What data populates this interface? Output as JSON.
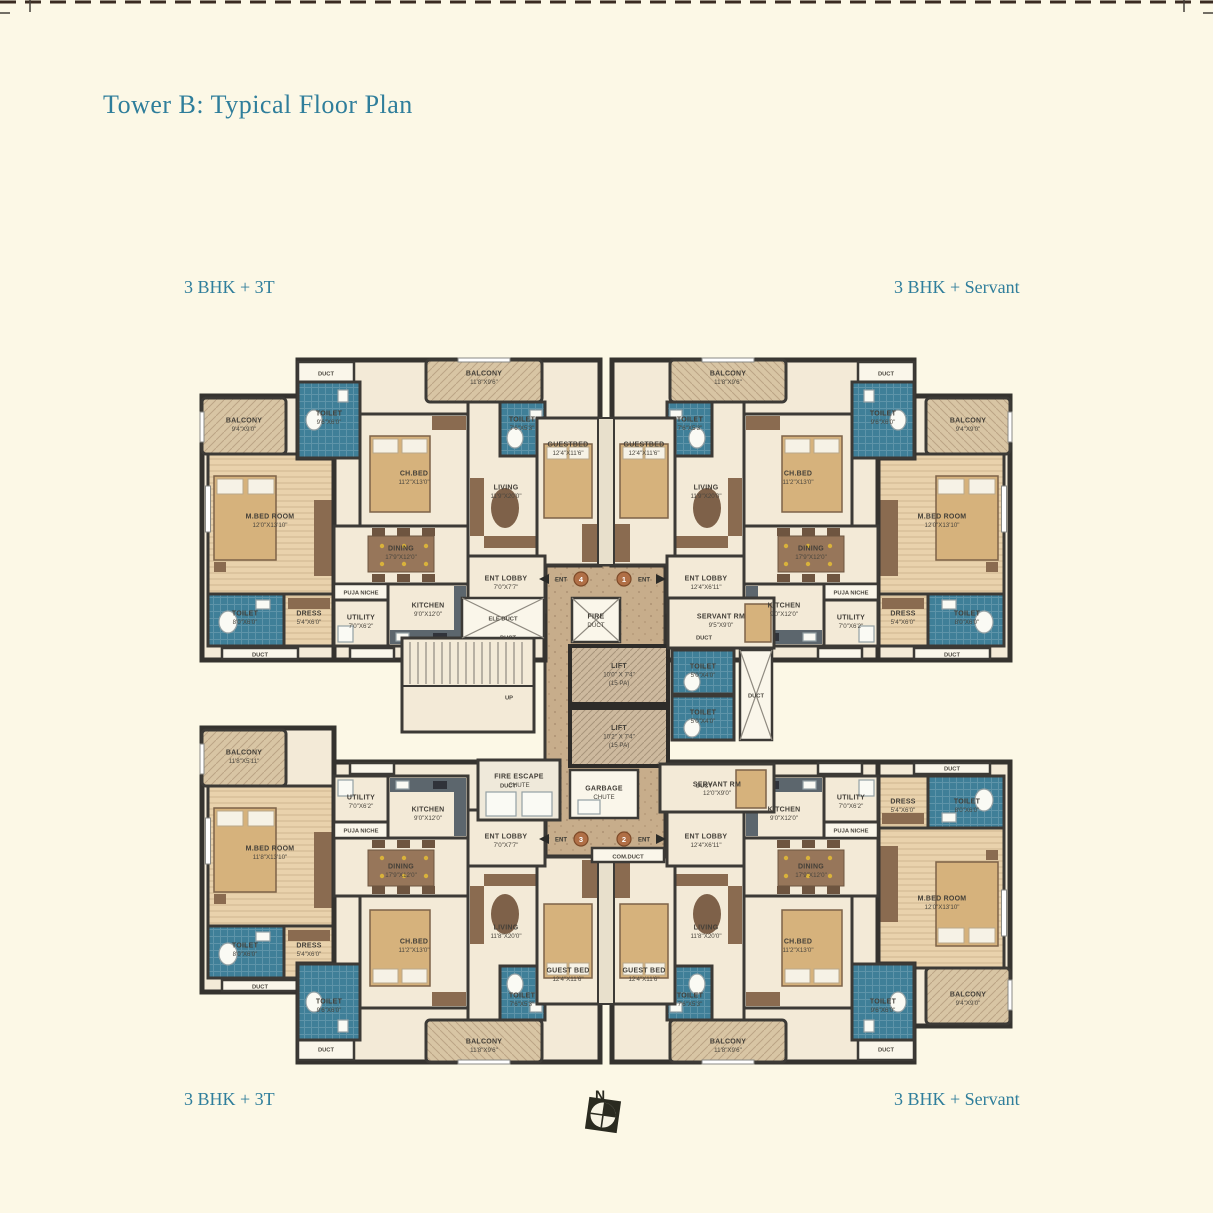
{
  "page": {
    "title": "Tower B: Typical Floor Plan"
  },
  "unit_labels": {
    "top_left": "3 BHK + 3T",
    "top_right": "3 BHK + Servant",
    "bottom_left": "3 BHK + 3T",
    "bottom_right": "3 BHK + Servant"
  },
  "compass": {
    "label": "N"
  },
  "palette": {
    "page_bg": "#FCF8E6",
    "heading_teal": "#2F7E9B",
    "wall": "#3C3A36",
    "room_cream": "#F3EAD7",
    "bedroom_wood": "#E9D2AC",
    "balcony_tan": "#D8C5A4",
    "corridor_tan": "#C7AD8B",
    "wet_teal": "#3F7F98",
    "furniture_brown": "#8A6B50",
    "bed_tan": "#D6B27C",
    "counter_slate": "#5C666D",
    "entrance_orange": "#B06F46"
  },
  "rooms": {
    "balcony_9x9": {
      "name": "BALCONY",
      "dims": "9'4\"X9'0\""
    },
    "balcony_11x9": {
      "name": "BALCONY",
      "dims": "11'8\"X9'6\""
    },
    "balcony_bl": {
      "name": "BALCONY",
      "dims": "11'8\"X5'11\""
    },
    "mbed": {
      "name": "M.BED ROOM",
      "dims": "12'0\"X13'10\""
    },
    "mbed_bl": {
      "name": "M.BED ROOM",
      "dims": "11'8\"X13'10\""
    },
    "toilet_wing": {
      "name": "TOILET",
      "dims": "8'0\"X6'0\""
    },
    "dress": {
      "name": "DRESS",
      "dims": "5'4\"X6'0\""
    },
    "toilet_9x6": {
      "name": "TOILET",
      "dims": "9'6\"X6'0\""
    },
    "toilet_7x5": {
      "name": "TOILET",
      "dims": "7'6\"X5'3\""
    },
    "chbed": {
      "name": "CH.BED",
      "dims": "11'2\"X13'0\""
    },
    "living": {
      "name": "LIVING",
      "dims": "11'9\"X20'0\""
    },
    "living_b": {
      "name": "LIVING",
      "dims": "11'8\"X20'0\""
    },
    "guestbed": {
      "name": "GUESTBED",
      "dims": "12'4\"X11'6\""
    },
    "guestbed_b": {
      "name": "GUEST BED",
      "dims": "12'4\"X11'6\""
    },
    "dining": {
      "name": "DINING",
      "dims": "17'9\"X12'0\""
    },
    "kitchen": {
      "name": "KITCHEN",
      "dims": "9'0\"X12'0\""
    },
    "utility": {
      "name": "UTILITY",
      "dims": "7'0\"X6'2\""
    },
    "puja": {
      "name": "PUJA NICHE"
    },
    "ent_lobby_l": {
      "name": "ENT LOBBY",
      "dims": "7'0\"X7'7\""
    },
    "ent_lobby_r": {
      "name": "ENT LOBBY",
      "dims": "12'4\"X6'11\""
    },
    "servant_t": {
      "name": "SERVANT RM",
      "dims": "9'5\"X9'0\""
    },
    "servant_b": {
      "name": "SERVANT RM",
      "dims": "12'0\"X9'0\""
    },
    "lift1": {
      "name": "LIFT",
      "dims": "10'0\" X 7'4\"",
      "capacity": "(15 PA)"
    },
    "lift2": {
      "name": "LIFT",
      "dims": "10'2\" X 7'4\"",
      "capacity": "(15 PA)"
    },
    "toilet_core": {
      "name": "TOILET",
      "dims": "5'0\"X4'0\""
    },
    "fire_duct": {
      "name": "FIRE",
      "name2": "DUCT"
    },
    "ele_duct": {
      "name": "ELE DUCT"
    },
    "garbage": {
      "name": "GARBAGE",
      "name2": "CHUTE"
    },
    "fire_escape": {
      "name": "FIRE ESCAPE",
      "name2": "CHUTE"
    },
    "com_duct": {
      "name": "COM.DUCT"
    },
    "duct": {
      "name": "DUCT"
    },
    "up": {
      "name": "UP"
    }
  },
  "entrances": {
    "e1": {
      "no": "1",
      "label": "ENT"
    },
    "e2": {
      "no": "2",
      "label": "ENT"
    },
    "e3": {
      "no": "3",
      "label": "ENT"
    },
    "e4": {
      "no": "4",
      "label": "ENT"
    }
  },
  "plan": {
    "labels_wing_tl": [
      {
        "x": 44,
        "y": 64,
        "lines": [
          "rooms.balcony_9x9.name",
          "rooms.balcony_9x9.dims"
        ]
      },
      {
        "x": 70,
        "y": 160,
        "lines": [
          "rooms.mbed.name",
          "rooms.mbed.dims"
        ]
      },
      {
        "x": 45,
        "y": 257,
        "lines": [
          "rooms.toilet_wing.name",
          "rooms.toilet_wing.dims"
        ]
      },
      {
        "x": 109,
        "y": 257,
        "lines": [
          "rooms.dress.name",
          "rooms.dress.dims"
        ]
      },
      {
        "x": 60,
        "y": 294,
        "lines": [
          "rooms.duct.name"
        ],
        "small": true
      }
    ],
    "labels_wing_tr": [
      {
        "x": 44,
        "y": 64,
        "lines": [
          "rooms.balcony_9x9.name",
          "rooms.balcony_9x9.dims"
        ]
      },
      {
        "x": 70,
        "y": 160,
        "lines": [
          "rooms.mbed.name",
          "rooms.mbed.dims"
        ]
      },
      {
        "x": 45,
        "y": 257,
        "lines": [
          "rooms.toilet_wing.name",
          "rooms.toilet_wing.dims"
        ]
      },
      {
        "x": 109,
        "y": 257,
        "lines": [
          "rooms.dress.name",
          "rooms.dress.dims"
        ]
      },
      {
        "x": 60,
        "y": 294,
        "lines": [
          "rooms.duct.name"
        ],
        "small": true
      }
    ],
    "labels_wing_bl": [
      {
        "x": 44,
        "y": 64,
        "lines": [
          "rooms.balcony_bl.name",
          "rooms.balcony_bl.dims"
        ]
      },
      {
        "x": 70,
        "y": 160,
        "lines": [
          "rooms.mbed_bl.name",
          "rooms.mbed_bl.dims"
        ]
      },
      {
        "x": 45,
        "y": 257,
        "lines": [
          "rooms.toilet_wing.name",
          "rooms.toilet_wing.dims"
        ]
      },
      {
        "x": 109,
        "y": 257,
        "lines": [
          "rooms.dress.name",
          "rooms.dress.dims"
        ]
      },
      {
        "x": 60,
        "y": 294,
        "lines": [
          "rooms.duct.name"
        ],
        "small": true
      }
    ],
    "labels_wing_br": [
      {
        "x": 44,
        "y": 64,
        "lines": [
          "rooms.balcony_9x9.name",
          "rooms.balcony_9x9.dims"
        ]
      },
      {
        "x": 70,
        "y": 160,
        "lines": [
          "rooms.mbed.name",
          "rooms.mbed.dims"
        ]
      },
      {
        "x": 45,
        "y": 257,
        "lines": [
          "rooms.toilet_wing.name",
          "rooms.toilet_wing.dims"
        ]
      },
      {
        "x": 109,
        "y": 257,
        "lines": [
          "rooms.dress.name",
          "rooms.dress.dims"
        ]
      },
      {
        "x": 60,
        "y": 294,
        "lines": [
          "rooms.duct.name"
        ],
        "small": true
      }
    ],
    "labels_main_tl": [
      {
        "x": 126,
        "y": 13,
        "lines": [
          "rooms.duct.name"
        ],
        "small": true
      },
      {
        "x": 129,
        "y": 57,
        "lines": [
          "rooms.toilet_9x6.name",
          "rooms.toilet_9x6.dims"
        ]
      },
      {
        "x": 214,
        "y": 117,
        "lines": [
          "rooms.chbed.name",
          "rooms.chbed.dims"
        ]
      },
      {
        "x": 284,
        "y": 17,
        "lines": [
          "rooms.balcony_11x9.name",
          "rooms.balcony_11x9.dims"
        ]
      },
      {
        "x": 306,
        "y": 131,
        "lines": [
          "rooms.living.name",
          "rooms.living.dims"
        ]
      },
      {
        "x": 322,
        "y": 63,
        "lines": [
          "rooms.toilet_7x5.name",
          "rooms.toilet_7x5.dims"
        ]
      },
      {
        "x": 368,
        "y": 88,
        "lines": [
          "rooms.guestbed.name",
          "rooms.guestbed.dims"
        ]
      },
      {
        "x": 201,
        "y": 192,
        "lines": [
          "rooms.dining.name",
          "rooms.dining.dims"
        ]
      },
      {
        "x": 161,
        "y": 232,
        "lines": [
          "rooms.puja.name"
        ],
        "small": true
      },
      {
        "x": 161,
        "y": 261,
        "lines": [
          "rooms.utility.name",
          "rooms.utility.dims"
        ]
      },
      {
        "x": 228,
        "y": 249,
        "lines": [
          "rooms.kitchen.name",
          "rooms.kitchen.dims"
        ]
      },
      {
        "x": 306,
        "y": 222,
        "lines": [
          "rooms.ent_lobby_l.name",
          "rooms.ent_lobby_l.dims"
        ]
      },
      {
        "x": 308,
        "y": 277,
        "lines": [
          "rooms.duct.name"
        ],
        "small": true
      }
    ],
    "labels_main_tr": [
      {
        "x": 126,
        "y": 13,
        "lines": [
          "rooms.duct.name"
        ],
        "small": true
      },
      {
        "x": 129,
        "y": 57,
        "lines": [
          "rooms.toilet_9x6.name",
          "rooms.toilet_9x6.dims"
        ]
      },
      {
        "x": 214,
        "y": 117,
        "lines": [
          "rooms.chbed.name",
          "rooms.chbed.dims"
        ]
      },
      {
        "x": 284,
        "y": 17,
        "lines": [
          "rooms.balcony_11x9.name",
          "rooms.balcony_11x9.dims"
        ]
      },
      {
        "x": 306,
        "y": 131,
        "lines": [
          "rooms.living.name",
          "rooms.living.dims"
        ]
      },
      {
        "x": 322,
        "y": 63,
        "lines": [
          "rooms.toilet_7x5.name",
          "rooms.toilet_7x5.dims"
        ]
      },
      {
        "x": 368,
        "y": 88,
        "lines": [
          "rooms.guestbed.name",
          "rooms.guestbed.dims"
        ]
      },
      {
        "x": 201,
        "y": 192,
        "lines": [
          "rooms.dining.name",
          "rooms.dining.dims"
        ]
      },
      {
        "x": 161,
        "y": 232,
        "lines": [
          "rooms.puja.name"
        ],
        "small": true
      },
      {
        "x": 161,
        "y": 261,
        "lines": [
          "rooms.utility.name",
          "rooms.utility.dims"
        ]
      },
      {
        "x": 228,
        "y": 249,
        "lines": [
          "rooms.kitchen.name",
          "rooms.kitchen.dims"
        ]
      },
      {
        "x": 306,
        "y": 222,
        "lines": [
          "rooms.ent_lobby_r.name",
          "rooms.ent_lobby_r.dims"
        ]
      },
      {
        "x": 308,
        "y": 277,
        "lines": [
          "rooms.duct.name"
        ],
        "small": true
      }
    ],
    "labels_main_bl": [
      {
        "x": 126,
        "y": 13,
        "lines": [
          "rooms.duct.name"
        ],
        "small": true
      },
      {
        "x": 129,
        "y": 57,
        "lines": [
          "rooms.toilet_9x6.name",
          "rooms.toilet_9x6.dims"
        ]
      },
      {
        "x": 214,
        "y": 117,
        "lines": [
          "rooms.chbed.name",
          "rooms.chbed.dims"
        ]
      },
      {
        "x": 284,
        "y": 17,
        "lines": [
          "rooms.balcony_11x9.name",
          "rooms.balcony_11x9.dims"
        ]
      },
      {
        "x": 306,
        "y": 131,
        "lines": [
          "rooms.living_b.name",
          "rooms.living_b.dims"
        ]
      },
      {
        "x": 322,
        "y": 63,
        "lines": [
          "rooms.toilet_7x5.name",
          "rooms.toilet_7x5.dims"
        ]
      },
      {
        "x": 368,
        "y": 88,
        "lines": [
          "rooms.guestbed_b.name",
          "rooms.guestbed_b.dims"
        ]
      },
      {
        "x": 201,
        "y": 192,
        "lines": [
          "rooms.dining.name",
          "rooms.dining.dims"
        ]
      },
      {
        "x": 161,
        "y": 232,
        "lines": [
          "rooms.puja.name"
        ],
        "small": true
      },
      {
        "x": 161,
        "y": 261,
        "lines": [
          "rooms.utility.name",
          "rooms.utility.dims"
        ]
      },
      {
        "x": 228,
        "y": 249,
        "lines": [
          "rooms.kitchen.name",
          "rooms.kitchen.dims"
        ]
      },
      {
        "x": 306,
        "y": 222,
        "lines": [
          "rooms.ent_lobby_l.name",
          "rooms.ent_lobby_l.dims"
        ]
      },
      {
        "x": 308,
        "y": 277,
        "lines": [
          "rooms.duct.name"
        ],
        "small": true
      }
    ],
    "labels_main_br": [
      {
        "x": 126,
        "y": 13,
        "lines": [
          "rooms.duct.name"
        ],
        "small": true
      },
      {
        "x": 129,
        "y": 57,
        "lines": [
          "rooms.toilet_9x6.name",
          "rooms.toilet_9x6.dims"
        ]
      },
      {
        "x": 214,
        "y": 117,
        "lines": [
          "rooms.chbed.name",
          "rooms.chbed.dims"
        ]
      },
      {
        "x": 284,
        "y": 17,
        "lines": [
          "rooms.balcony_11x9.name",
          "rooms.balcony_11x9.dims"
        ]
      },
      {
        "x": 306,
        "y": 131,
        "lines": [
          "rooms.living_b.name",
          "rooms.living_b.dims"
        ]
      },
      {
        "x": 322,
        "y": 63,
        "lines": [
          "rooms.toilet_7x5.name",
          "rooms.toilet_7x5.dims"
        ]
      },
      {
        "x": 368,
        "y": 88,
        "lines": [
          "rooms.guestbed_b.name",
          "rooms.guestbed_b.dims"
        ]
      },
      {
        "x": 201,
        "y": 192,
        "lines": [
          "rooms.dining.name",
          "rooms.dining.dims"
        ]
      },
      {
        "x": 161,
        "y": 232,
        "lines": [
          "rooms.puja.name"
        ],
        "small": true
      },
      {
        "x": 161,
        "y": 261,
        "lines": [
          "rooms.utility.name",
          "rooms.utility.dims"
        ]
      },
      {
        "x": 228,
        "y": 249,
        "lines": [
          "rooms.kitchen.name",
          "rooms.kitchen.dims"
        ]
      },
      {
        "x": 306,
        "y": 222,
        "lines": [
          "rooms.ent_lobby_r.name",
          "rooms.ent_lobby_r.dims"
        ]
      },
      {
        "x": 308,
        "y": 277,
        "lines": [
          "rooms.duct.name"
        ],
        "small": true
      }
    ],
    "labels_core": [
      {
        "x": 503,
        "y": 618,
        "lines": [
          "rooms.ele_duct.name"
        ],
        "small": true
      },
      {
        "x": 596,
        "y": 620,
        "lines": [
          "rooms.fire_duct.name",
          "rooms.fire_duct.name2"
        ]
      },
      {
        "x": 619,
        "y": 674,
        "lines": [
          "rooms.lift1.name",
          "rooms.lift1.dims",
          "rooms.lift1.capacity"
        ]
      },
      {
        "x": 619,
        "y": 736,
        "lines": [
          "rooms.lift2.name",
          "rooms.lift2.dims",
          "rooms.lift2.capacity"
        ]
      },
      {
        "x": 604,
        "y": 792,
        "lines": [
          "rooms.garbage.name",
          "rooms.garbage.name2"
        ]
      },
      {
        "x": 519,
        "y": 780,
        "lines": [
          "rooms.fire_escape.name",
          "rooms.fire_escape.name2"
        ]
      },
      {
        "x": 628,
        "y": 856,
        "lines": [
          "rooms.com_duct.name"
        ],
        "small": true
      },
      {
        "x": 721,
        "y": 620,
        "lines": [
          "rooms.servant_t.name",
          "rooms.servant_t.dims"
        ]
      },
      {
        "x": 717,
        "y": 788,
        "lines": [
          "rooms.servant_b.name",
          "rooms.servant_b.dims"
        ]
      },
      {
        "x": 703,
        "y": 670,
        "lines": [
          "rooms.toilet_core.name",
          "rooms.toilet_core.dims"
        ]
      },
      {
        "x": 703,
        "y": 716,
        "lines": [
          "rooms.toilet_core.name",
          "rooms.toilet_core.dims"
        ]
      },
      {
        "x": 756,
        "y": 695,
        "lines": [
          "rooms.duct.name"
        ],
        "small": true
      },
      {
        "x": 509,
        "y": 697,
        "lines": [
          "rooms.up.name"
        ],
        "small": true
      }
    ]
  }
}
